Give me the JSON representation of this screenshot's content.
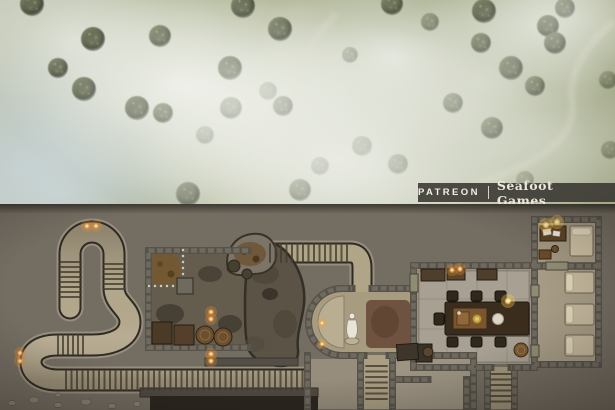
{
  "watermark": {
    "platform": "PATREON",
    "separator": "|",
    "brand": "Seafoot Games"
  },
  "palette": {
    "meadow_base": "#a6ac90",
    "fog": "#e9ebe4",
    "bush": "#4b513b",
    "trail": "#d6d8c4",
    "rock": "#7b7569",
    "corridor_floor": "#b4a88c",
    "corridor_edge": "#2f2b24",
    "cave_floor": "#5b5446",
    "cellar_floor": "#645d4e",
    "room_floor": "#a7a093",
    "wall_stone": "#57524a",
    "carpet": "#6f5340",
    "pit": "#2a261f",
    "torch_glow": "#e78a2e",
    "lantern_glow": "#ffcf5e",
    "banner_bg": "rgba(56,53,48,0.88)",
    "banner_text": "#f2efe9"
  },
  "meadow": {
    "bushes": [
      [
        32,
        4,
        12,
        0.9
      ],
      [
        93,
        39,
        12,
        0.95
      ],
      [
        58,
        68,
        10,
        0.85
      ],
      [
        84,
        89,
        12,
        0.9
      ],
      [
        160,
        36,
        11,
        0.9
      ],
      [
        137,
        108,
        12,
        0.95
      ],
      [
        163,
        113,
        10,
        0.9
      ],
      [
        243,
        6,
        12,
        1
      ],
      [
        280,
        29,
        12,
        1
      ],
      [
        230,
        68,
        12,
        1
      ],
      [
        231,
        108,
        11,
        0.95
      ],
      [
        283,
        106,
        10,
        0.9
      ],
      [
        188,
        194,
        12,
        0.85
      ],
      [
        392,
        4,
        11,
        0.8
      ],
      [
        484,
        11,
        12,
        1
      ],
      [
        548,
        26,
        11,
        1
      ],
      [
        481,
        43,
        10,
        0.9
      ],
      [
        555,
        43,
        11,
        0.95
      ],
      [
        511,
        68,
        12,
        0.95
      ],
      [
        535,
        86,
        10,
        0.85
      ],
      [
        453,
        103,
        10,
        0.8
      ],
      [
        492,
        128,
        11,
        0.85
      ],
      [
        362,
        146,
        10,
        0.5
      ],
      [
        398,
        164,
        10,
        0.6
      ],
      [
        320,
        166,
        9,
        0.45
      ],
      [
        268,
        91,
        9,
        0.5
      ],
      [
        205,
        135,
        9,
        0.5
      ],
      [
        300,
        190,
        11,
        0.75
      ],
      [
        565,
        8,
        10,
        0.9
      ],
      [
        608,
        80,
        9,
        0.5
      ],
      [
        430,
        22,
        9,
        0.55
      ],
      [
        350,
        55,
        8,
        0.4
      ],
      [
        610,
        150,
        9,
        0.45
      ],
      [
        525,
        180,
        9,
        0.4
      ]
    ]
  },
  "dungeon": {
    "lights": [
      {
        "x": 87,
        "y": 22,
        "kind": "torch"
      },
      {
        "x": 96,
        "y": 22,
        "kind": "torch"
      },
      {
        "x": 20,
        "y": 149,
        "kind": "torch"
      },
      {
        "x": 20,
        "y": 157,
        "kind": "torch"
      },
      {
        "x": 211,
        "y": 108,
        "kind": "torch"
      },
      {
        "x": 211,
        "y": 115,
        "kind": "torch"
      },
      {
        "x": 211,
        "y": 150,
        "kind": "torch"
      },
      {
        "x": 211,
        "y": 157,
        "kind": "torch"
      },
      {
        "x": 322,
        "y": 119,
        "kind": "candle"
      },
      {
        "x": 322,
        "y": 140,
        "kind": "candle"
      },
      {
        "x": 452,
        "y": 66,
        "kind": "torch"
      },
      {
        "x": 460,
        "y": 65,
        "kind": "torch"
      },
      {
        "x": 508,
        "y": 97,
        "kind": "lantern"
      },
      {
        "x": 546,
        "y": 21,
        "kind": "lantern"
      },
      {
        "x": 557,
        "y": 18,
        "kind": "lantern"
      }
    ],
    "stairs": [
      {
        "dir": "v",
        "a1": 60,
        "a2": 81,
        "b1": 58,
        "b2": 96,
        "step": 5
      },
      {
        "dir": "v",
        "a1": 104,
        "a2": 125,
        "b1": 60,
        "b2": 88,
        "step": 5
      },
      {
        "dir": "h",
        "a1": 131,
        "a2": 150,
        "b1": 58,
        "b2": 86,
        "step": 5
      },
      {
        "dir": "h",
        "a1": 167,
        "a2": 186,
        "b1": 66,
        "b2": 304,
        "step": 5.5
      },
      {
        "dir": "h",
        "a1": 40,
        "a2": 58,
        "b1": 270,
        "b2": 348,
        "step": 5.5
      },
      {
        "dir": "v",
        "a1": 366,
        "a2": 387,
        "b1": 162,
        "b2": 200,
        "step": 5.5
      },
      {
        "dir": "v",
        "a1": 491,
        "a2": 511,
        "b1": 170,
        "b2": 202,
        "step": 5.5
      }
    ],
    "features": [
      "winding-stair-corridor",
      "storage-cellar",
      "central-cavern",
      "shrine-hall-with-statue",
      "dining-hall",
      "study-bedroom",
      "bunk-room",
      "lower-store-rooms",
      "descending-staircases",
      "collapsed-rubble",
      "crates-and-barrels",
      "dark-pit"
    ]
  }
}
